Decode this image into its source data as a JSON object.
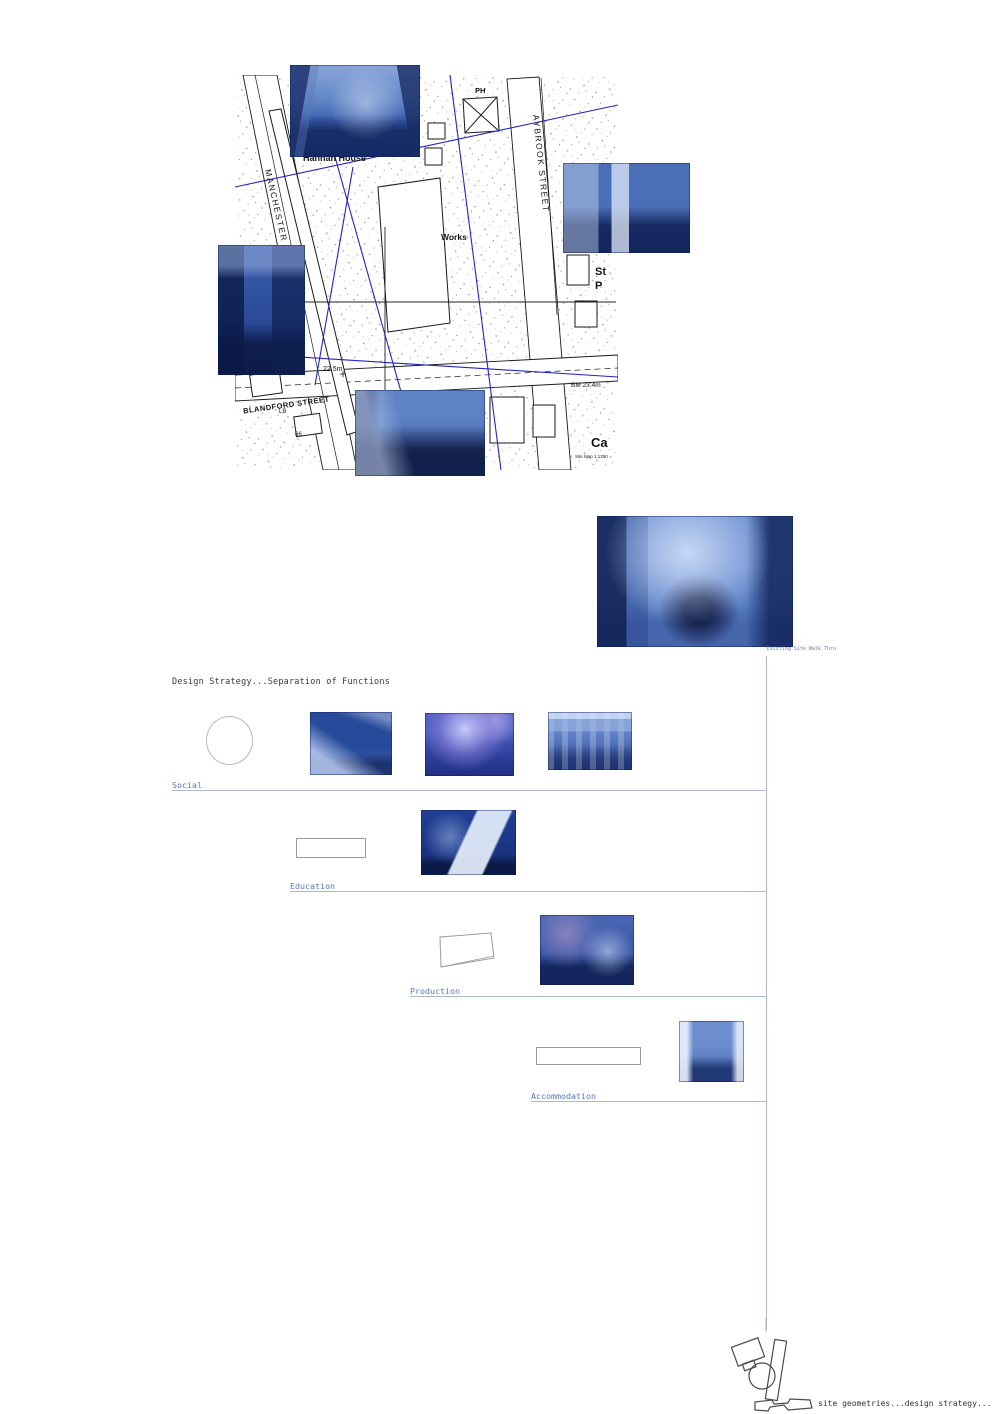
{
  "colors": {
    "photo_tint": "#2f5cb4",
    "geometry_line_blue": "#2424c4",
    "link_blue": "#5577bb",
    "rule_gray": "#a9b9cb",
    "map_ink": "#1a1a1a"
  },
  "map": {
    "labels": {
      "manchester_street": "MANCHESTER STREET",
      "aybrook_street": "AYBROOK STREET",
      "hannah_house": "Hannah House",
      "works": "Works",
      "ph": "PH",
      "st": "St",
      "p": "P",
      "blandford_street": "BLANDFORD STREET",
      "spot_height": "22.5m",
      "benchmark": "BM 23.4m",
      "lb": "LB",
      "building_number": "66",
      "ca": "Ca",
      "scale_note": "Site Map 1:1250"
    }
  },
  "walkthrough": {
    "caption": "Existing Site Walk Thru"
  },
  "strategy": {
    "title": "Design Strategy...Separation of Functions",
    "rows": [
      {
        "label": "Social"
      },
      {
        "label": "Education"
      },
      {
        "label": "Production"
      },
      {
        "label": "Accommodation"
      }
    ]
  },
  "footer": {
    "caption": "site geometries...design strategy..."
  }
}
